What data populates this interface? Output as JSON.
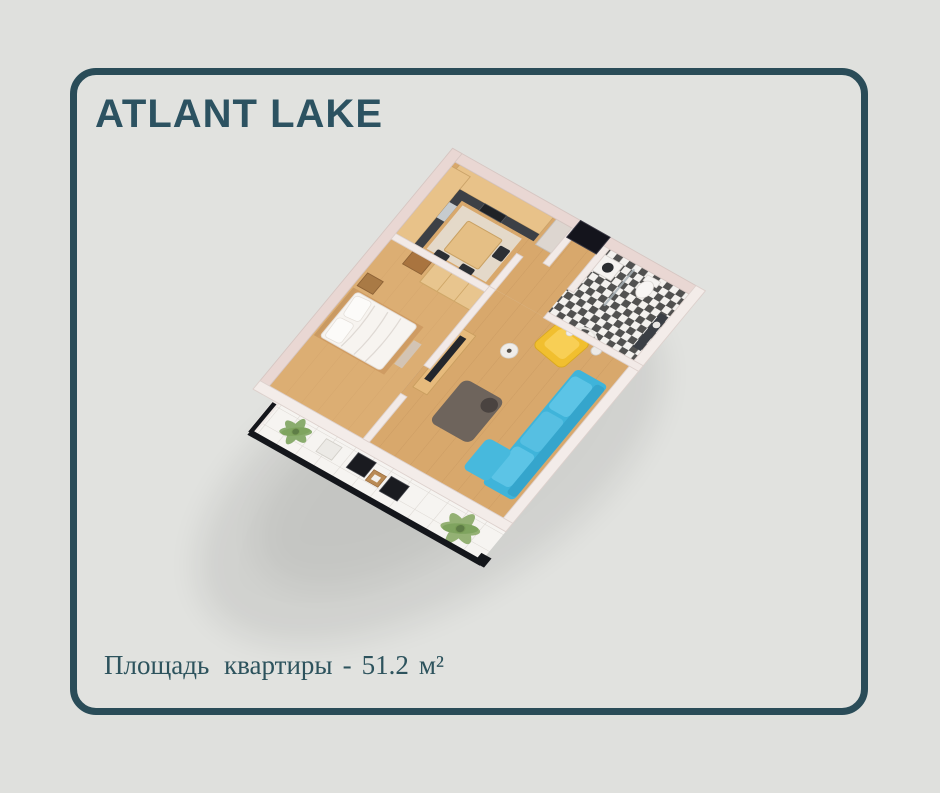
{
  "page": {
    "background": "#dfe0dd"
  },
  "card": {
    "title": "ATLANT LAKE",
    "title_color": "#2c5261",
    "border_color": "#2a4c58"
  },
  "area": {
    "label": "Площадь  квартиры",
    "separator": "-",
    "value": "51.2",
    "unit": "м²",
    "text_color": "#2d535d"
  },
  "floorplan": {
    "type": "isometric-3d-apartment-render",
    "rooms": [
      "kitchen",
      "hallway",
      "bathroom",
      "bedroom",
      "living-room",
      "balcony"
    ],
    "furniture": [
      "kitchen-cabinets",
      "countertop",
      "stove",
      "sink",
      "fridge-cabinet",
      "dining-table",
      "dining-chairs",
      "entry-door",
      "washing-machine",
      "toilet",
      "shower-screen",
      "vanity",
      "wardrobe",
      "dresser",
      "double-bed",
      "pillows",
      "nightstand",
      "tv-stand",
      "tv",
      "coffee-table",
      "side-table",
      "sofa",
      "armchair",
      "floor-lamp",
      "balcony-chairs",
      "balcony-table",
      "palm-plants",
      "railing"
    ],
    "colors": {
      "walls_outer": "#e9d7d3",
      "walls_inner": "#f2eae7",
      "wood_floor": "#d8a86c",
      "bedroom_floor_tint": "#e6bb80",
      "balcony_tile": "#f6f4f1",
      "bathroom_tile_dark": "#353535",
      "cabinets": "#e8c289",
      "countertop": "#3c4046",
      "dining_table": "#e5bf85",
      "entry_door": "#14141c",
      "bed": "#f7f4f0",
      "wardrobe": "#e8c58e",
      "tv_screen": "#23262c",
      "coffee_table": "#6e645c",
      "sofa": "#3fb4da",
      "armchair": "#f1bf2f",
      "palm_leaf": "#85a968",
      "railing": "#14161b"
    }
  }
}
